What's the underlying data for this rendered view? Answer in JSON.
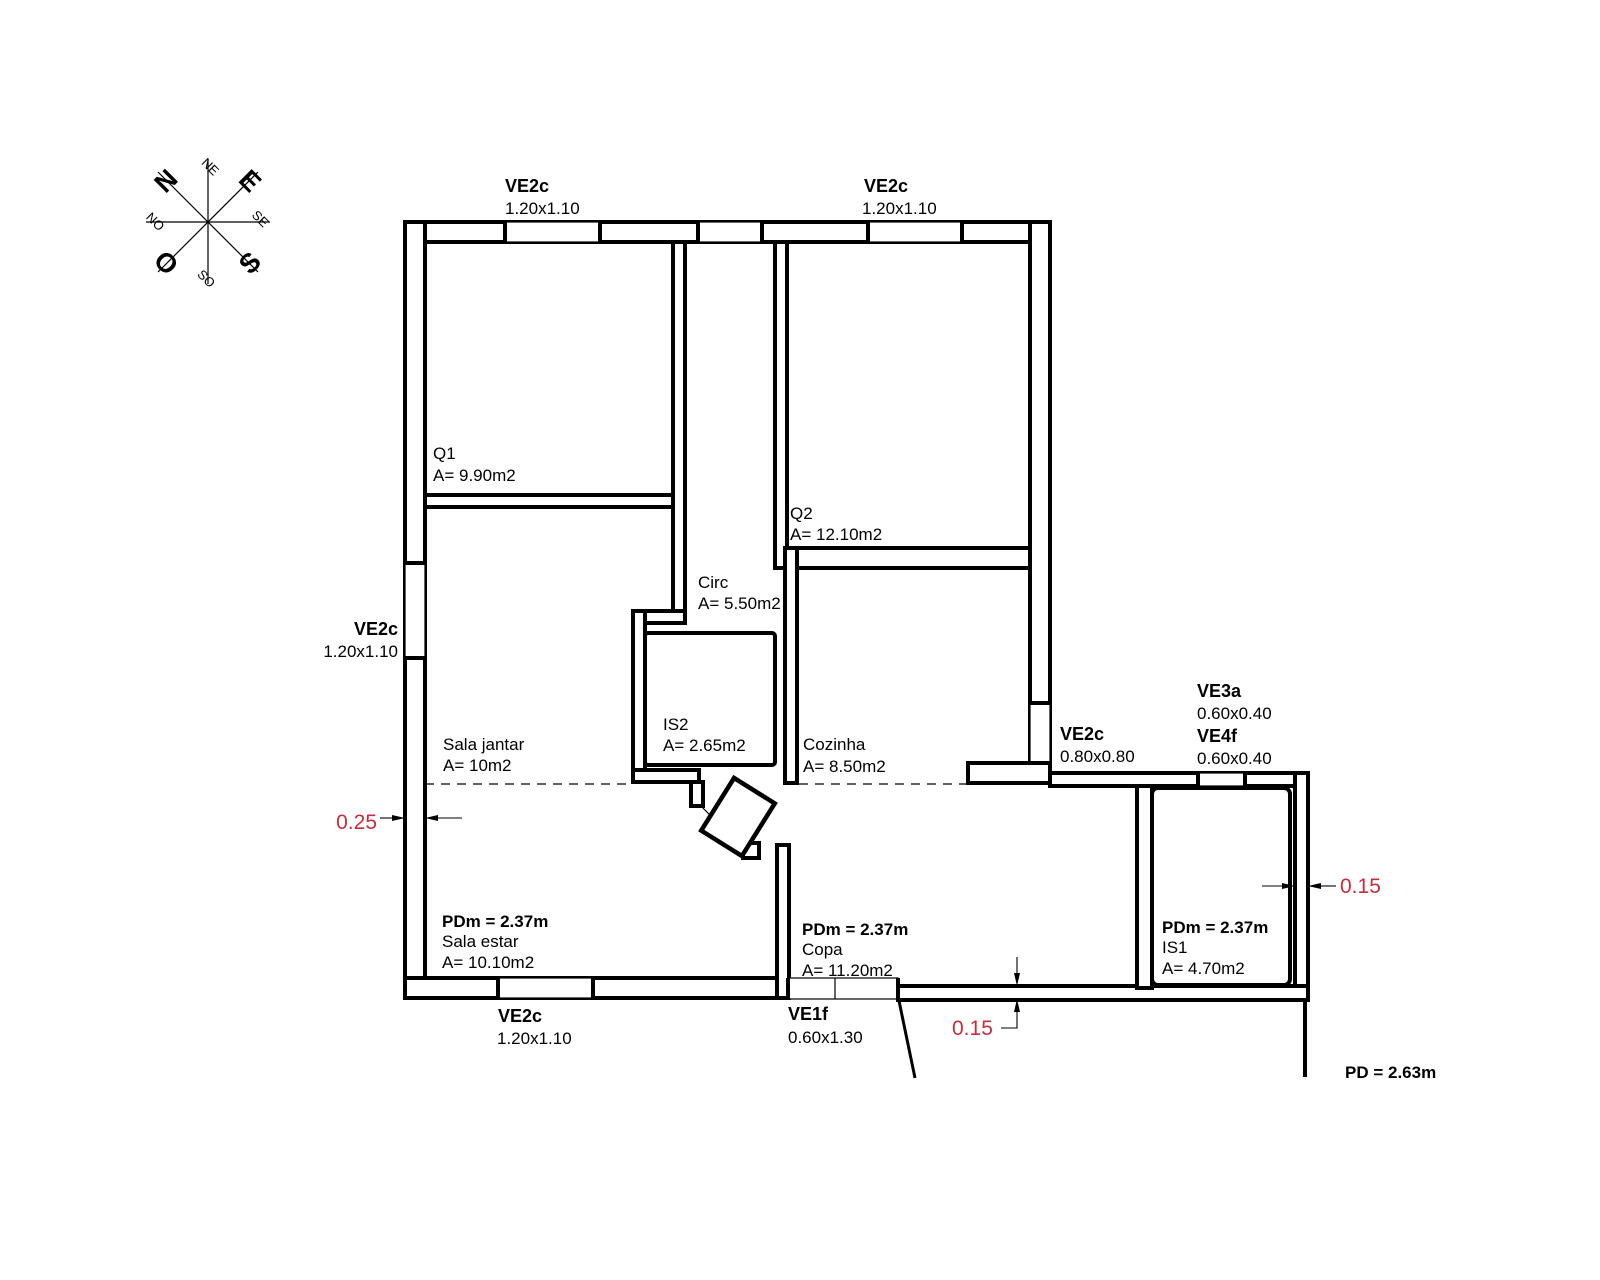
{
  "title": "Planta baixa residencial",
  "compass": {
    "n": "N",
    "e": "E",
    "s": "S",
    "o": "O",
    "ne": "NE",
    "se": "SE",
    "so": "SO",
    "no": "NO"
  },
  "windows": {
    "top_left": {
      "code": "VE2c",
      "size": "1.20x1.10"
    },
    "top_right": {
      "code": "VE2c",
      "size": "1.20x1.10"
    },
    "left": {
      "code": "VE2c",
      "size": "1.20x1.10"
    },
    "bottom": {
      "code": "VE2c",
      "size": "1.20x1.10"
    },
    "entry": {
      "code": "VE1f",
      "size": "0.60x1.30"
    },
    "kitchen": {
      "code": "VE2c",
      "size": "0.80x0.80"
    },
    "ve3a": {
      "code": "VE3a",
      "size": "0.60x0.40"
    },
    "ve4f": {
      "code": "VE4f",
      "size": "0.60x0.40"
    }
  },
  "rooms": {
    "q1": {
      "name": "Q1",
      "area": "A= 9.90m2"
    },
    "q2": {
      "name": "Q2",
      "area": "A= 12.10m2"
    },
    "circ": {
      "name": "Circ",
      "area": "A= 5.50m2"
    },
    "is2": {
      "name": "IS2",
      "area": "A= 2.65m2"
    },
    "cozinha": {
      "name": "Cozinha",
      "area": "A= 8.50m2"
    },
    "sala_jantar": {
      "name": "Sala jantar",
      "area": "A= 10m2"
    },
    "sala_estar": {
      "name": "Sala estar",
      "area": "A= 10.10m2",
      "pdm": "PDm = 2.37m"
    },
    "copa": {
      "name": "Copa",
      "area": "A= 11.20m2",
      "pdm": "PDm = 2.37m"
    },
    "is1": {
      "name": "IS1",
      "area": "A= 4.70m2",
      "pdm": "PDm = 2.37m"
    }
  },
  "dimensions": {
    "left_wall": "0.25",
    "bottom_wall": "0.15",
    "right_wall": "0.15",
    "ceiling_height": "PD = 2.63m"
  },
  "colors": {
    "dimension_text": "#c82d3c",
    "line": "#000000",
    "background": "#ffffff"
  }
}
